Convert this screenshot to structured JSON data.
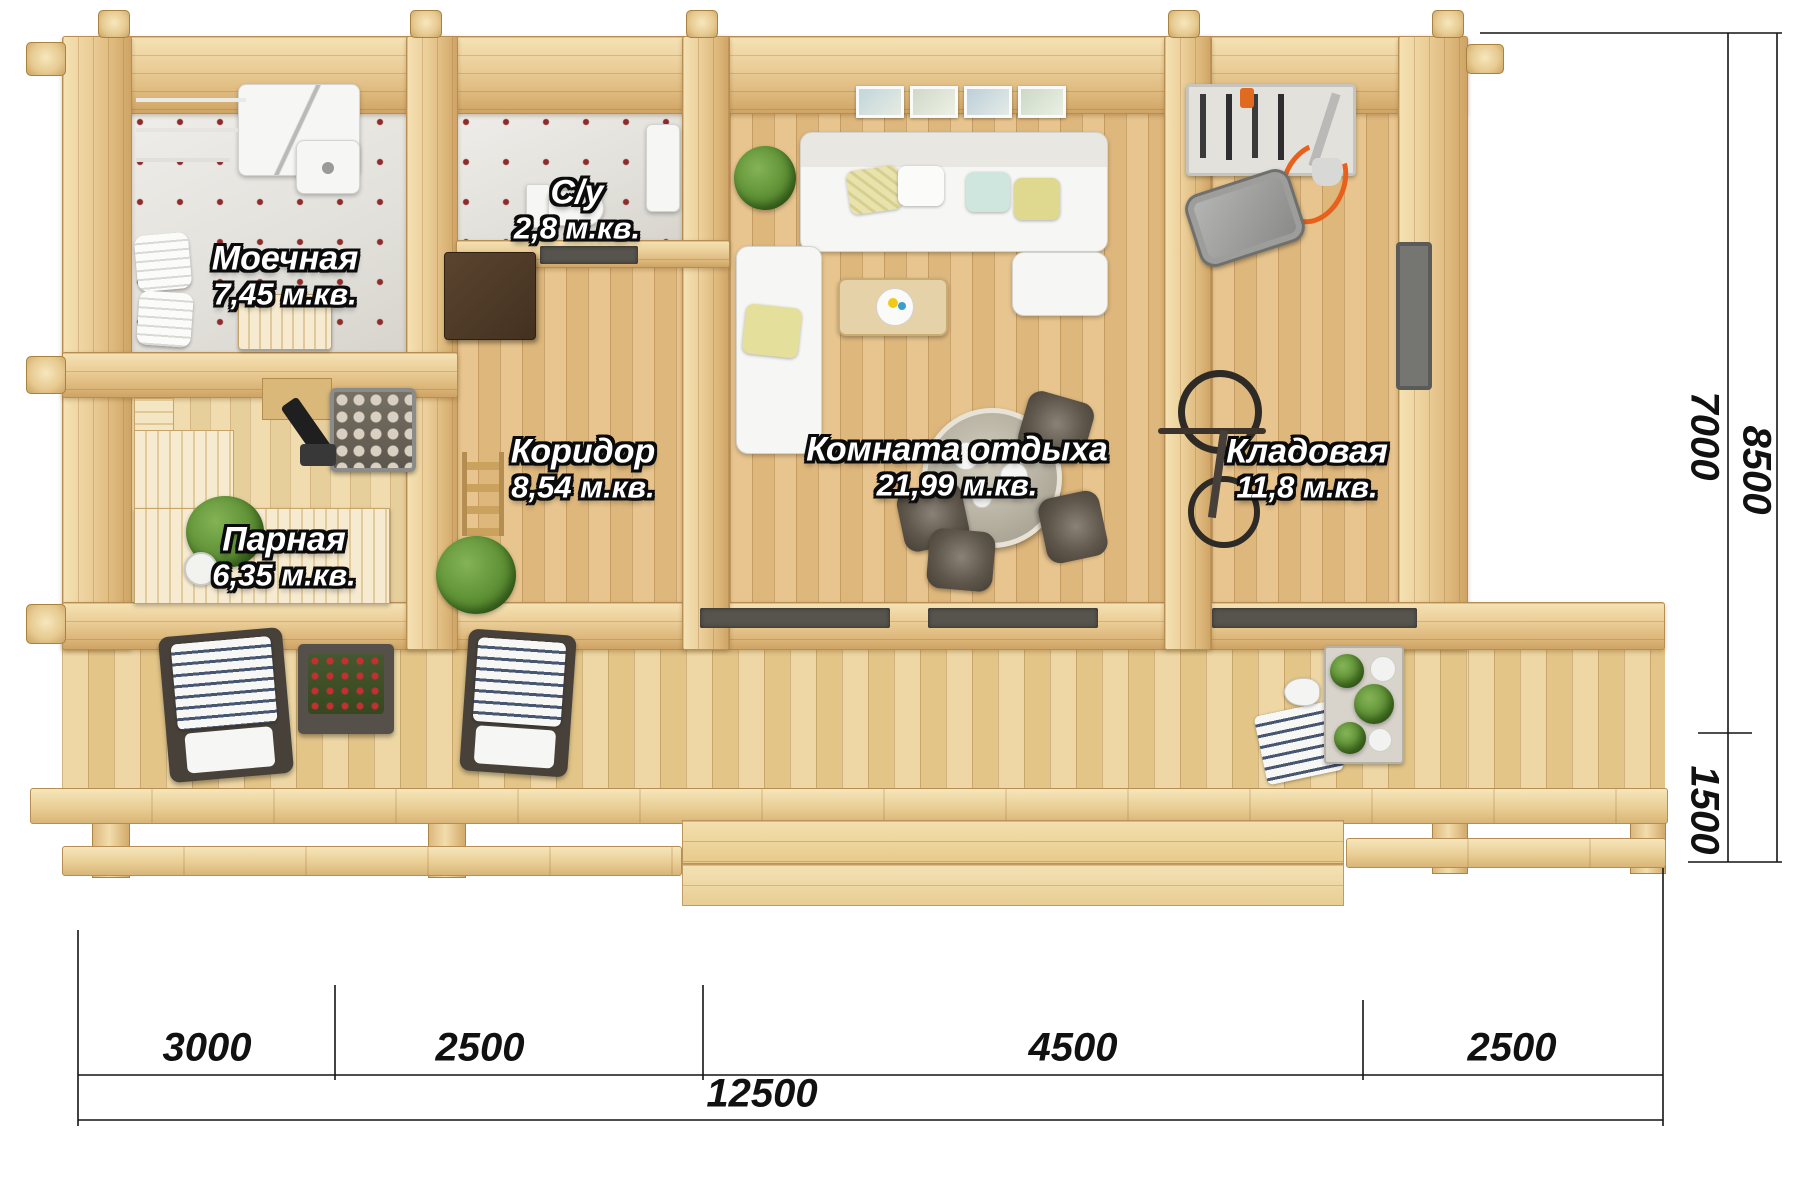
{
  "plan_type": "Floor plan of a log bathhouse (top-down 3D render)",
  "rooms": [
    {
      "name": "Моечная",
      "area": "7,45 м.кв."
    },
    {
      "name": "С/у",
      "area": "2,8 м.кв."
    },
    {
      "name": "Парная",
      "area": "6,35 м.кв."
    },
    {
      "name": "Коридор",
      "area": "8,54 м.кв."
    },
    {
      "name": "Комната отдыха",
      "area": "21,99 м.кв."
    },
    {
      "name": "Кладовая",
      "area": "11,8 м.кв."
    }
  ],
  "dimensions": {
    "bottom_segments": [
      "3000",
      "2500",
      "4500",
      "2500"
    ],
    "bottom_total": "12500",
    "right_upper": "7000",
    "right_total": "8500",
    "right_lower": "1500"
  },
  "colors": {
    "wood_light": "#f2dfae",
    "wood_mid": "#e3c183",
    "wood_dark": "#caa263",
    "tile": "#e9e7e2",
    "tile_dot": "#8e2b2b",
    "label_text": "#ffffff",
    "dim_text": "#111111",
    "accent_orange": "#e8611c"
  }
}
